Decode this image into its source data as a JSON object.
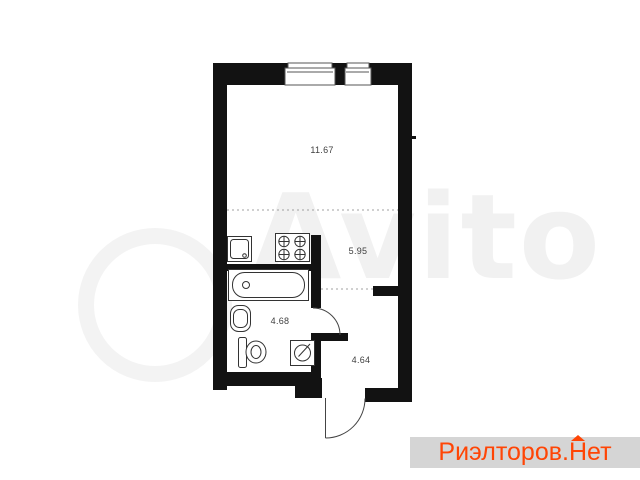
{
  "floor_plan": {
    "rooms": [
      {
        "name": "living-room",
        "area": "11.67"
      },
      {
        "name": "kitchen",
        "area": "5.95"
      },
      {
        "name": "bathroom",
        "area": "4.68"
      },
      {
        "name": "hallway",
        "area": "4.64"
      }
    ],
    "fixture_icons": [
      "kitchen-sink-icon",
      "stove-icon",
      "bathtub-icon",
      "washbasin-icon",
      "toilet-icon",
      "washing-machine-icon"
    ],
    "window_count": 2,
    "door_count": 3
  },
  "watermark": {
    "text": "Avito",
    "color": "#f1f1f1"
  },
  "badge": {
    "full_text": "Риэлторов.Нет",
    "part1": "Риэлторов.",
    "part2": "Н",
    "part3": "ет",
    "text_color": "#ff4505",
    "background": "#d5d5d5"
  },
  "colors": {
    "wall": "#121212",
    "fixture_stroke": "#333333",
    "door_stroke": "#444444",
    "dashed_line": "#a0a0a0",
    "label_text": "#3f3f3f"
  }
}
